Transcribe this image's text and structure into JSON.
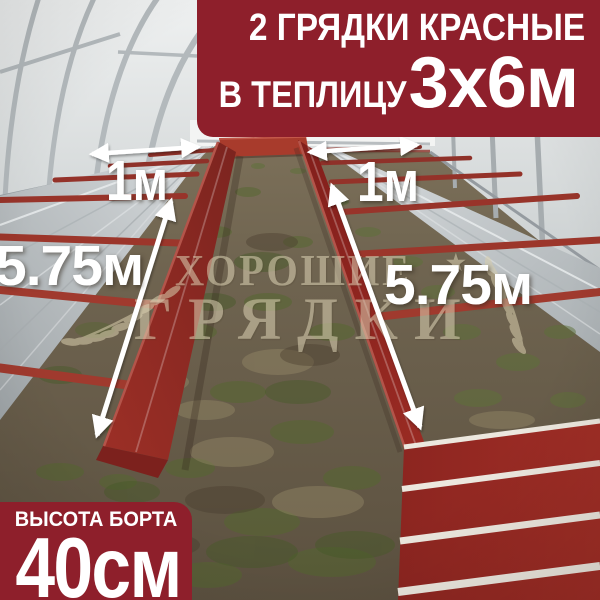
{
  "top_banner": {
    "line1": "2 ГРЯДКИ КРАСНЫЕ",
    "line2_label": "В ТЕПЛИЦУ",
    "line2_value": "3х6м",
    "bg_color": "#8e1f2b",
    "text_color": "#ffffff"
  },
  "bottom_banner": {
    "line1": "ВЫСОТА БОРТА",
    "line2": "40см",
    "bg_color": "#8e1f2b",
    "text_color": "#ffffff"
  },
  "dimension_labels": {
    "left_bed_width": "1м",
    "right_bed_width": "1м",
    "left_bed_length": "5.75м",
    "right_bed_length": "5.75м"
  },
  "watermark": {
    "line1": "ХОРОШИЕ",
    "line2": "ГРЯДКИ",
    "star": "★",
    "color": "#dcd2b4"
  },
  "photo_colors": {
    "bed_red": "#932a22",
    "galvanized_steel": "#c6cbcd",
    "ground": "#6f644e",
    "arrow_white": "#ffffff"
  }
}
